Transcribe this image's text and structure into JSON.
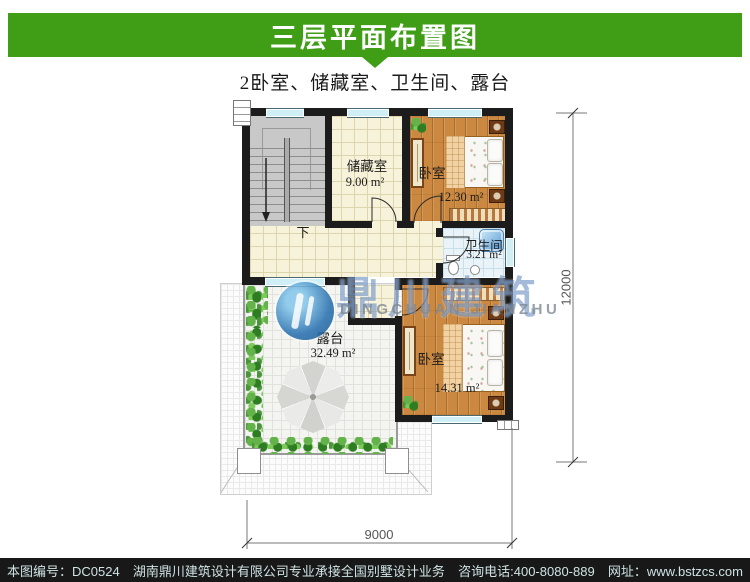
{
  "header": {
    "title": "三层平面布置图"
  },
  "subtitle": "2卧室、储藏室、卫生间、露台",
  "plan": {
    "stair_label": "下",
    "rooms": {
      "storage": {
        "label": "储藏室",
        "area": "9.00 m²"
      },
      "bedroom1": {
        "label": "卧室",
        "area": "12.30 m²"
      },
      "bathroom": {
        "label": "卫生间",
        "area": "3.21 m²"
      },
      "bedroom2": {
        "label": "卧室",
        "area": "14.31 m²"
      },
      "terrace": {
        "label": "露台",
        "area": "32.49 m²"
      }
    },
    "dimensions": {
      "height": "12000",
      "width": "9000"
    }
  },
  "watermark": {
    "logo_cn": "鼎川建筑",
    "logo_en": "DINGCHUAN JIANZHU"
  },
  "footer": {
    "drawing_no": "本图编号：DC0524",
    "company": "湖南鼎川建筑设计有限公司专业承接全国别墅设计业务",
    "phone": "咨询电话:400-8080-889",
    "website": "网址：www.bstzcs.com"
  },
  "colors": {
    "banner_green": "#3f9e16",
    "footer_bg": "#181818",
    "wall": "#1c1c1c"
  }
}
